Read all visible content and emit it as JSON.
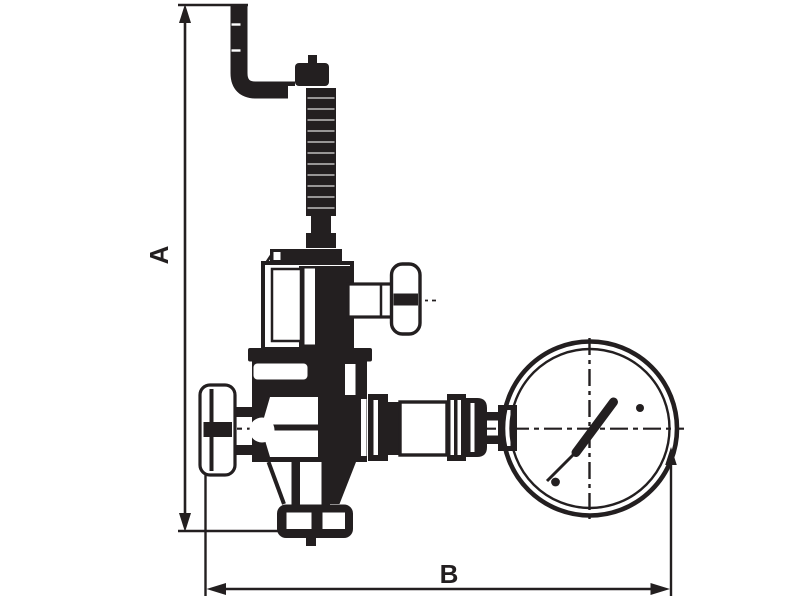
{
  "diagram": {
    "type": "technical-dimension-drawing",
    "subject": "Relief valve with test handle, inlet handwheel and pressure gauge",
    "background_color": "#ffffff",
    "ink_color": "#231f20",
    "dimension_labels": {
      "vertical": "A",
      "horizontal": "B"
    },
    "gauge": {
      "needle_direction": "upper-right"
    },
    "parts": [
      "outlet-pipe",
      "cap-nut",
      "adjusting-screw",
      "spring-housing",
      "test-handle",
      "valve-body",
      "inlet-handwheel",
      "bottom-union-nut",
      "gauge-piping",
      "pressure-gauge"
    ]
  }
}
